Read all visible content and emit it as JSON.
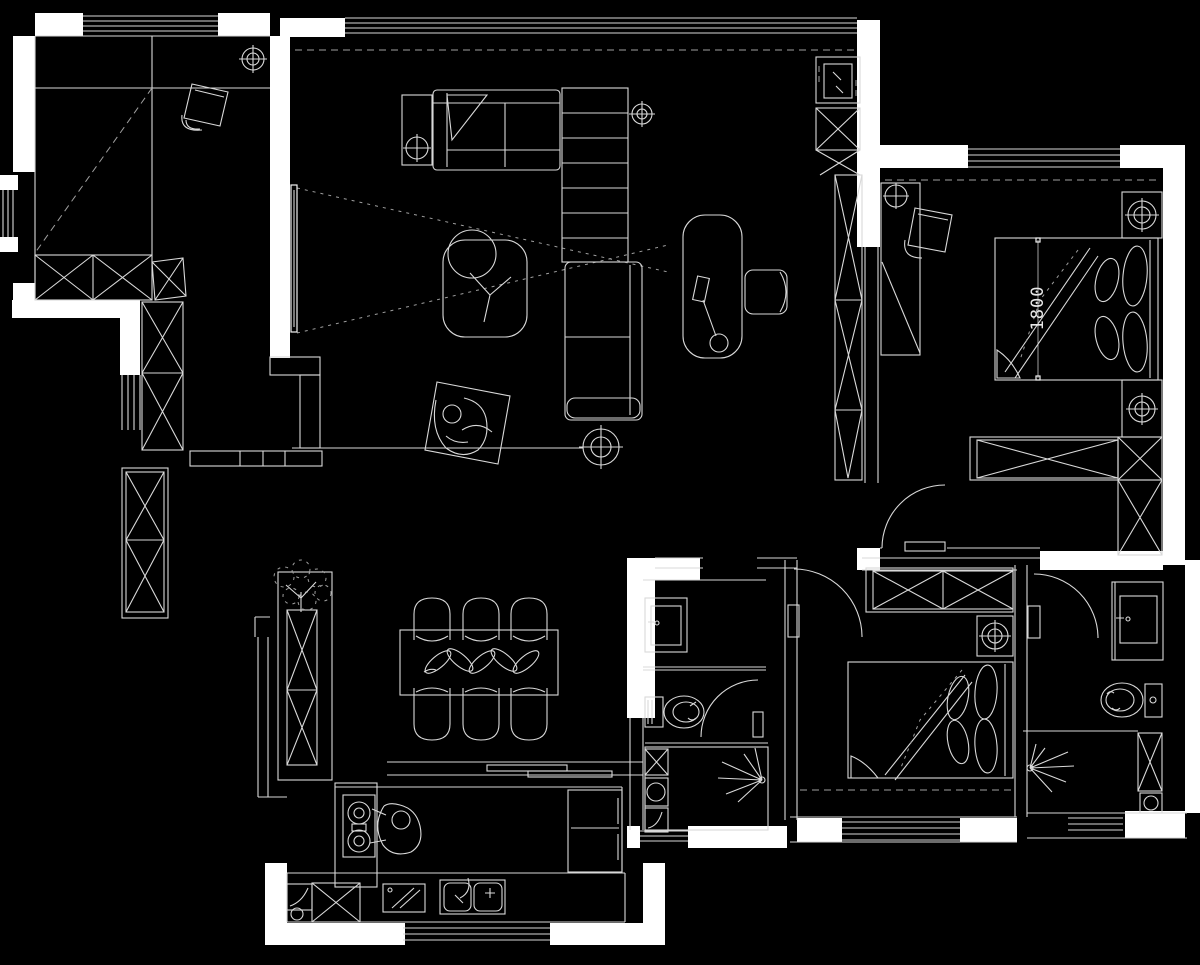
{
  "document": {
    "title": "apartment-floor-plan-drawing"
  },
  "canvas": {
    "width": 1200,
    "height": 965,
    "background": "#000000",
    "wall_fill": "#ffffff",
    "line_color": "#d9d9d9",
    "bright_line_color": "#f2f2f2",
    "dim_line_color": "#9f9f9f"
  },
  "annotations": {
    "bed_width_label": "1800"
  },
  "symbols": [
    "ceiling-lamp-icon",
    "table-lamp-icon",
    "floor-lamp-icon",
    "wardrobe-x-box-icon",
    "door-swing-arc-icon",
    "sliding-door-icon",
    "window-triple-line-icon",
    "shower-spray-icon",
    "toilet-icon",
    "washbasin-icon",
    "gas-stove-icon",
    "double-sink-icon",
    "refrigerator-icon",
    "plant-bonsai-icon",
    "person-figure-icon",
    "tv-projection-sightlines-icon",
    "curtain-dashed-line-icon"
  ],
  "rooms": [
    "study",
    "living-room",
    "master-bedroom",
    "dining-area",
    "kitchen",
    "bathroom",
    "second-bedroom",
    "ensuite-bathroom",
    "hallway"
  ]
}
